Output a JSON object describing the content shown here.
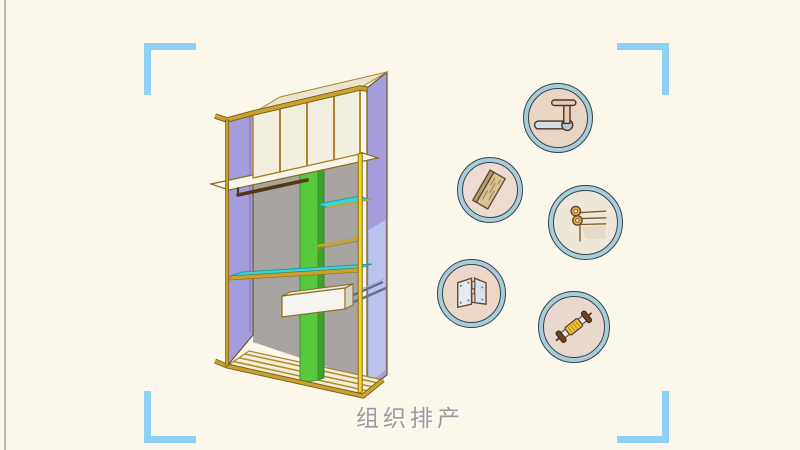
{
  "scene": {
    "background_color": "#fbf7ea",
    "caption": "组织排产",
    "caption_color": "#9b9b9b",
    "frame_bracket_color": "#8ed1f3"
  },
  "wardrobe": {
    "name": "wardrobe-frame-illustration",
    "colors": {
      "frame_gold": "#c9a12f",
      "post_yellow": "#f1d71a",
      "side_panel_purple": "#a49cdb",
      "side_panel_inner_blue": "#bcc3ec",
      "cupboard_cream": "#f3efde",
      "back_panel_gray": "#a8a4a1",
      "divider_green": "#58c93d",
      "shelf_cyan": "#38d6da",
      "drawer_white": "#f5f4ef",
      "hanging_rod_brown": "#543717",
      "floor_cream": "#f2ecd9"
    }
  },
  "parts": {
    "ring_color": "#a9ccd9",
    "ring_outline_color": "#33444c",
    "items": [
      {
        "icon": "closet-rod-bracket-icon",
        "inner_color": "#e8d5c3"
      },
      {
        "icon": "wood-plank-icon",
        "inner_color": "#eddbd2"
      },
      {
        "icon": "rail-hooks-icon",
        "inner_color": "#efe6da"
      },
      {
        "icon": "hinge-icon",
        "inner_color": "#ebd8c8"
      },
      {
        "icon": "connecting-bolt-icon",
        "inner_color": "#e9d8cc"
      }
    ]
  }
}
